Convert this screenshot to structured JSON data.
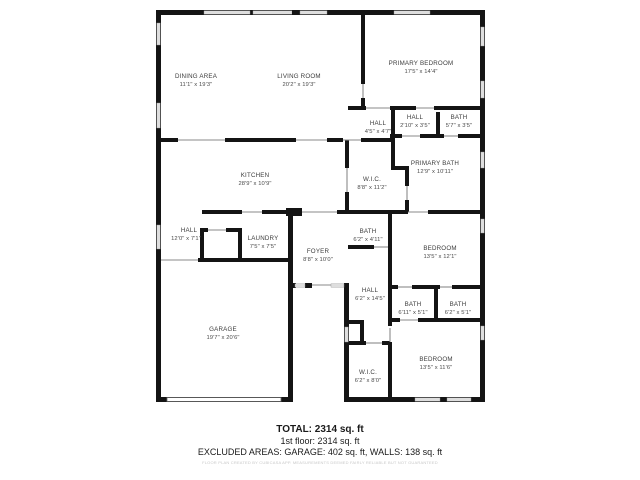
{
  "rooms": [
    {
      "name": "DINING AREA",
      "dims": "11'1\" x 19'3\""
    },
    {
      "name": "LIVING ROOM",
      "dims": "20'2\" x 19'3\""
    },
    {
      "name": "PRIMARY BEDROOM",
      "dims": "17'5\" x 14'4\""
    },
    {
      "name": "HALL",
      "dims": "4'5\" x 4'7\""
    },
    {
      "name": "HALL",
      "dims": "2'10\" x 3'5\""
    },
    {
      "name": "BATH",
      "dims": "5'7\" x 3'5\""
    },
    {
      "name": "PRIMARY BATH",
      "dims": "12'9\" x 10'11\""
    },
    {
      "name": "KITCHEN",
      "dims": "28'9\" x 10'9\""
    },
    {
      "name": "W.I.C.",
      "dims": "8'8\" x 11'2\""
    },
    {
      "name": "HALL",
      "dims": "12'0\" x 7'1\""
    },
    {
      "name": "LAUNDRY",
      "dims": "7'5\" x 7'5\""
    },
    {
      "name": "FOYER",
      "dims": "8'8\" x 10'0\""
    },
    {
      "name": "BATH",
      "dims": "6'2\" x 4'11\""
    },
    {
      "name": "BEDROOM",
      "dims": "13'5\" x 12'1\""
    },
    {
      "name": "HALL",
      "dims": "6'2\" x 14'5\""
    },
    {
      "name": "BATH",
      "dims": "6'11\" x 5'1\""
    },
    {
      "name": "BATH",
      "dims": "6'2\" x 5'1\""
    },
    {
      "name": "GARAGE",
      "dims": "19'7\" x 20'6\""
    },
    {
      "name": "W.I.C.",
      "dims": "6'2\" x 8'0\""
    },
    {
      "name": "BEDROOM",
      "dims": "13'5\" x 11'6\""
    }
  ],
  "summary": {
    "total": "TOTAL: 2314 sq. ft",
    "floor": "1st floor: 2314 sq. ft",
    "excluded": "EXCLUDED AREAS: GARAGE: 402 sq. ft, WALLS: 138 sq. ft",
    "disclaimer": "FLOOR PLAN CREATED BY CUBICASA APP. MEASUREMENTS DEEMED FAIRLY RELIABLE BUT NOT GUARANTEED"
  }
}
